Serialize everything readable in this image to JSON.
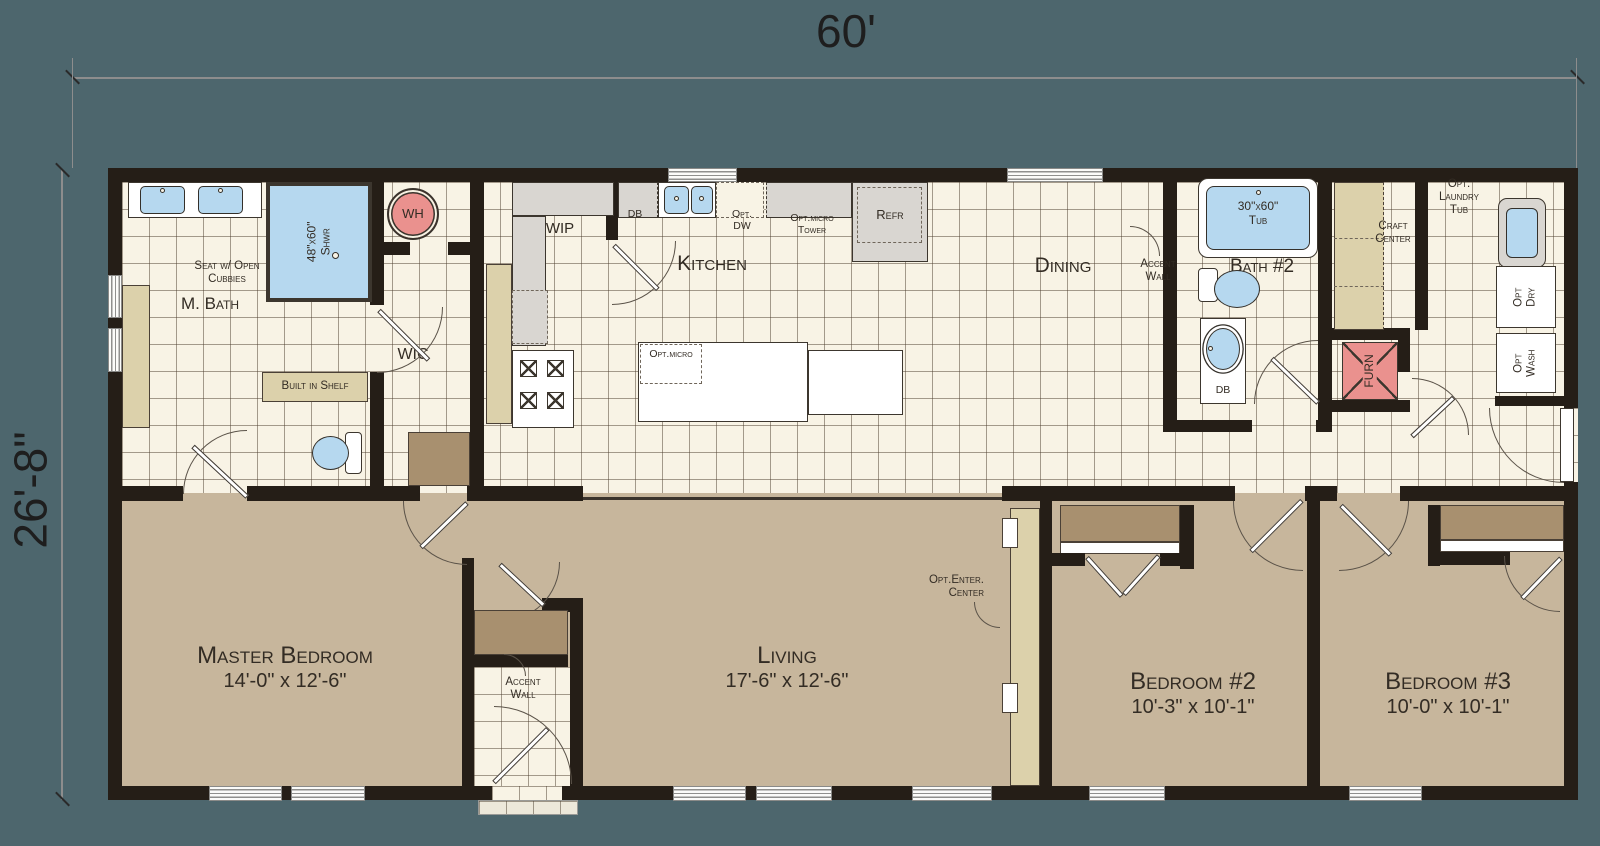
{
  "dimensions": {
    "width_label": "60'",
    "height_label": "26'-8\""
  },
  "rooms": {
    "master_bath": "M. Bath",
    "wic": "WIC",
    "wip": "WIP",
    "kitchen": "Kitchen",
    "dining": "Dining",
    "bath2": "Bath #2",
    "master_bedroom": {
      "name": "Master Bedroom",
      "size": "14'-0\" x 12'-6\""
    },
    "living": {
      "name": "Living",
      "size": "17'-6\" x 12'-6\""
    },
    "bedroom2": {
      "name": "Bedroom #2",
      "size": "10'-3\" x 10'-1\""
    },
    "bedroom3": {
      "name": "Bedroom #3",
      "size": "10'-0\" x 10'-1\""
    }
  },
  "features": {
    "seat_line1": "Seat w/ Open",
    "seat_line2": "Cubbies",
    "shower_line1": "48\"x60\"",
    "shower_line2": "Shwr",
    "water_heater": "WH",
    "built_in_shelf": "Built in Shelf",
    "db": "DB",
    "opt_dw_line1": "Opt.",
    "opt_dw_line2": "DW",
    "opt_micro_tower_line1": "Opt.micro",
    "opt_micro_tower_line2": "Tower",
    "refrigerator": "Refr",
    "opt_micro": "Opt.micro",
    "accent_line1": "Accent",
    "accent_line2": "Wall",
    "tub_line1": "30\"x60\"",
    "tub_line2": "Tub",
    "bath2_db": "DB",
    "craft_line1": "Craft",
    "craft_line2": "Center",
    "furnace": "FURN",
    "laundry_line1": "Opt.",
    "laundry_line2": "Laundry",
    "laundry_line3": "Tub",
    "opt_dry_line1": "Opt",
    "opt_dry_line2": "Dry",
    "opt_wash_line1": "Opt",
    "opt_wash_line2": "Wash",
    "enter_center_line1": "Opt.Enter.",
    "enter_center_line2": "Center"
  },
  "colors": {
    "background": "#4d666d",
    "walls": "#251e17",
    "tile_floor": "#f8f3e5",
    "carpet": "#c7b69c",
    "closet": "#a8906f",
    "cabinet_tan": "#dcd1ab",
    "fixture_blue": "#b6d8ef",
    "utility_red": "#ea918e",
    "appliance_gray": "#d9d6d1"
  }
}
